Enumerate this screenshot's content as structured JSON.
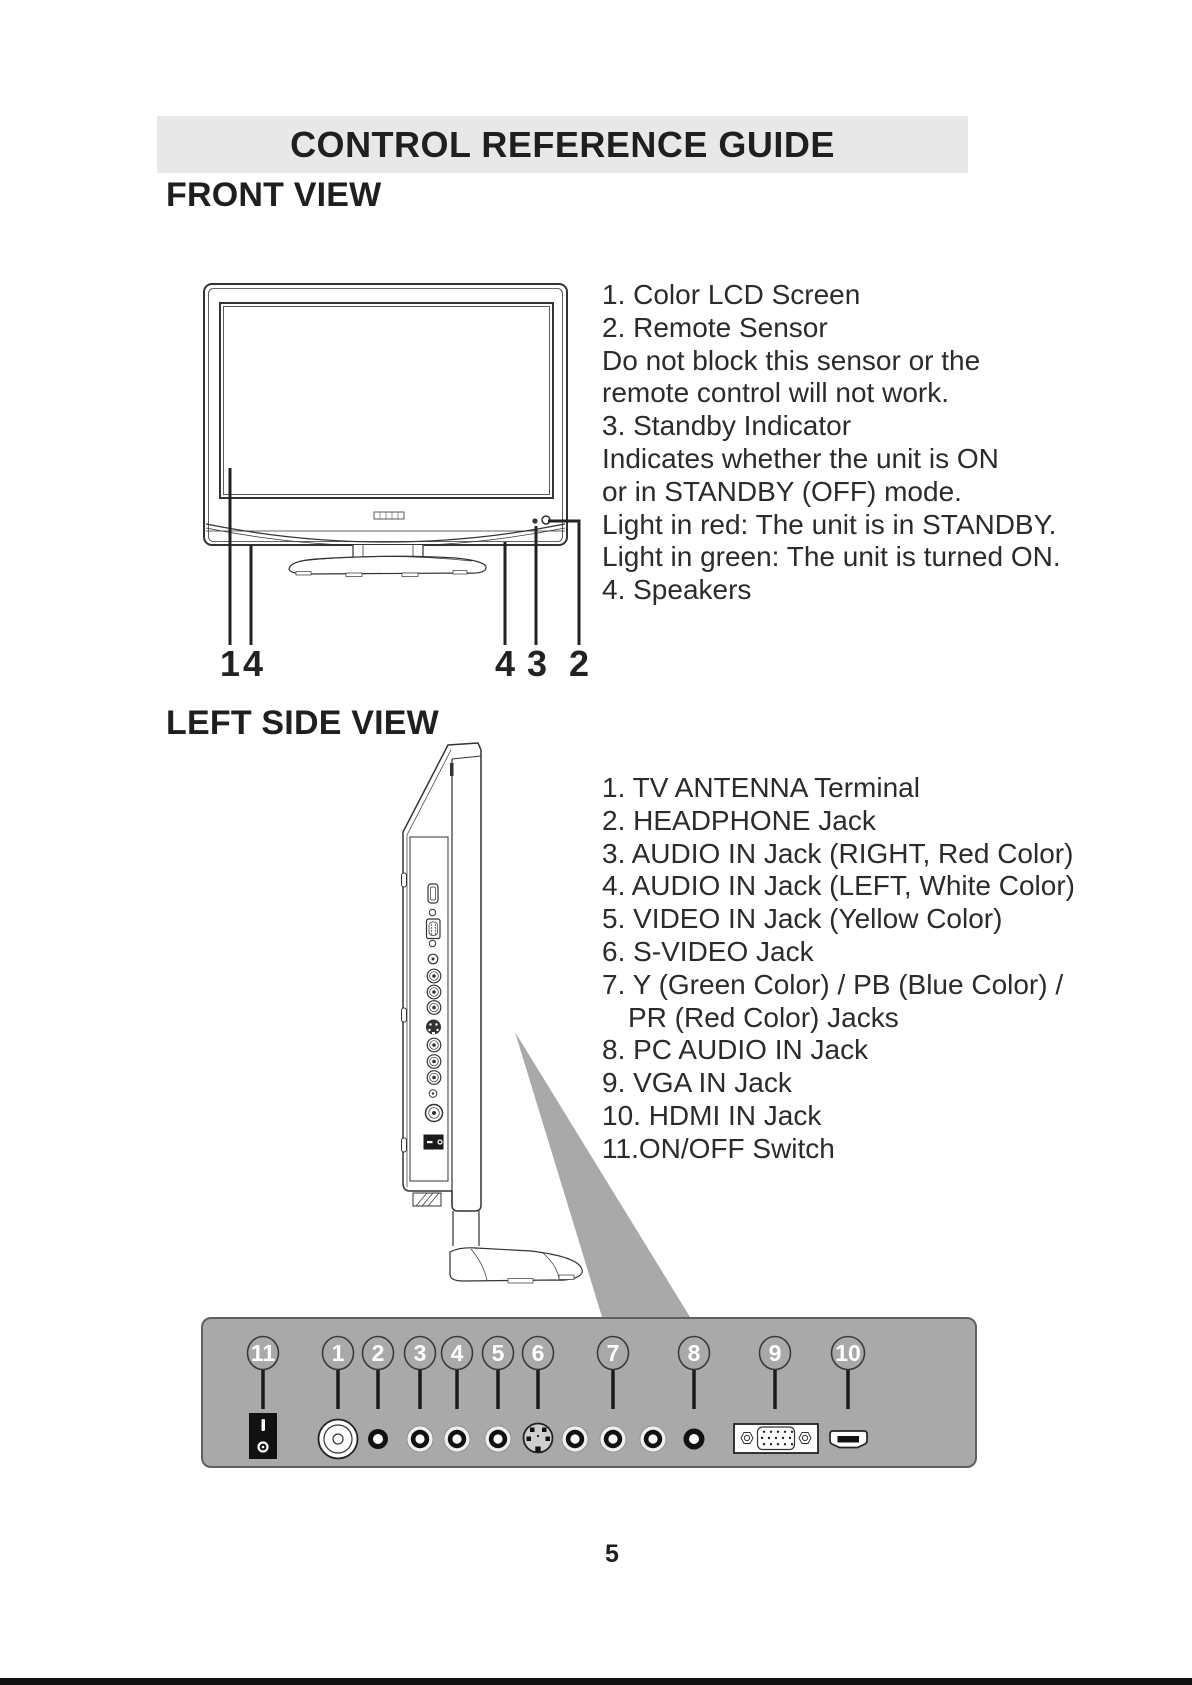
{
  "header": {
    "title": "CONTROL REFERENCE GUIDE"
  },
  "front_view": {
    "heading": "FRONT VIEW",
    "callouts": [
      "1",
      "4",
      "4",
      "3",
      "2"
    ],
    "notes": [
      "1. Color LCD Screen",
      "2. Remote Sensor",
      "Do not block this sensor or the",
      "remote control will not work.",
      "3. Standby Indicator",
      "Indicates whether the unit is ON",
      "or in STANDBY (OFF) mode.",
      "Light in red: The unit is in STANDBY.",
      "Light in green: The unit is turned ON.",
      "4. Speakers"
    ]
  },
  "side_view": {
    "heading": "LEFT SIDE VIEW",
    "notes": [
      "1. TV ANTENNA Terminal",
      "2. HEADPHONE Jack",
      "3. AUDIO IN Jack (RIGHT, Red Color)",
      "4. AUDIO IN Jack (LEFT, White Color)",
      "5. VIDEO IN Jack (Yellow Color)",
      "6. S-VIDEO Jack",
      "7. Y (Green Color) / PB (Blue Color) /",
      "PR (Red Color) Jacks",
      "8. PC AUDIO IN Jack",
      "9. VGA IN Jack",
      "10. HDMI IN Jack",
      "11.ON/OFF Switch"
    ]
  },
  "connector_panel": {
    "badges": [
      "11",
      "1",
      "2",
      "3",
      "4",
      "5",
      "6",
      "7",
      "8",
      "9",
      "10"
    ]
  },
  "footer": {
    "page_number": "5"
  },
  "colors": {
    "title_bar_bg": "#e8e8e8",
    "panel_gray": "#a9a9a9",
    "line": "#333333",
    "text": "#2b2b2b"
  }
}
